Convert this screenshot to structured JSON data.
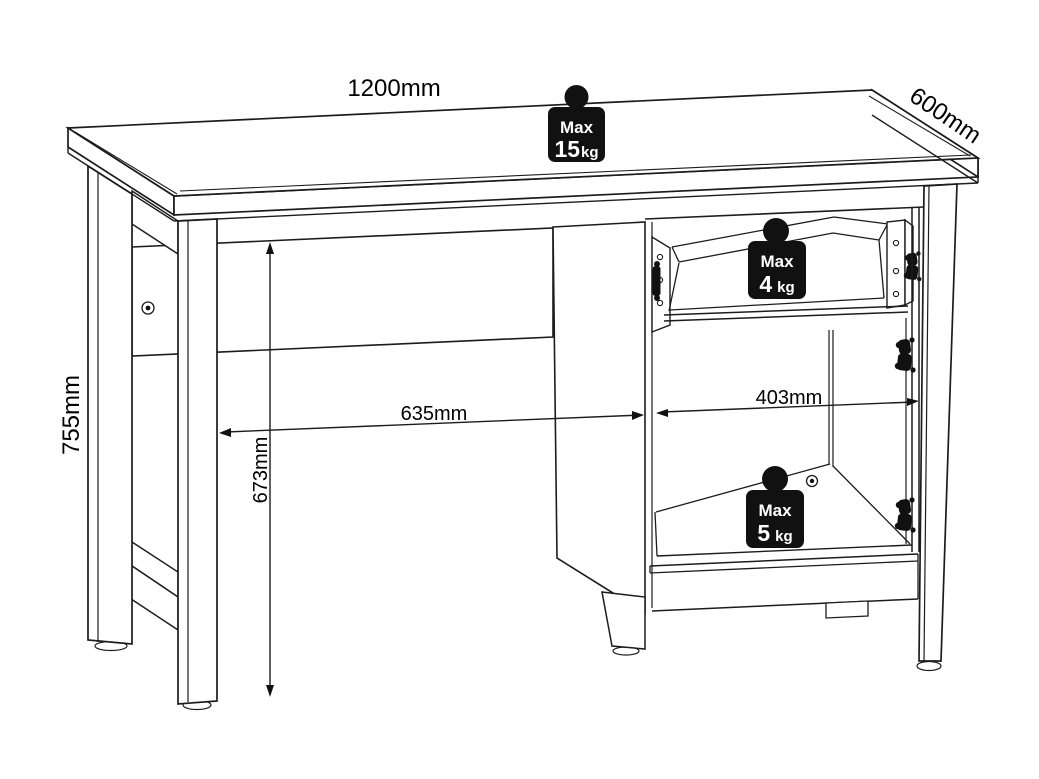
{
  "title": "Desk dimensions technical drawing",
  "background": "#ffffff",
  "line_color": "#1c1c1c",
  "icon_style": {
    "bg": "#111111",
    "text_color": "#ffffff"
  },
  "dimensions": {
    "top_width": {
      "label": "1200mm"
    },
    "top_depth": {
      "label": "600mm"
    },
    "overall_height": {
      "label": "755mm"
    },
    "knee_space_width": {
      "label": "635mm"
    },
    "knee_space_height": {
      "label": "673mm"
    },
    "cabinet_width": {
      "label": "403mm"
    }
  },
  "load_limits": {
    "desktop": {
      "prefix": "Max",
      "value": "15",
      "unit": "kg"
    },
    "drawer": {
      "prefix": "Max",
      "value": "4",
      "unit": "kg"
    },
    "cabinet": {
      "prefix": "Max",
      "value": "5",
      "unit": "kg"
    }
  }
}
